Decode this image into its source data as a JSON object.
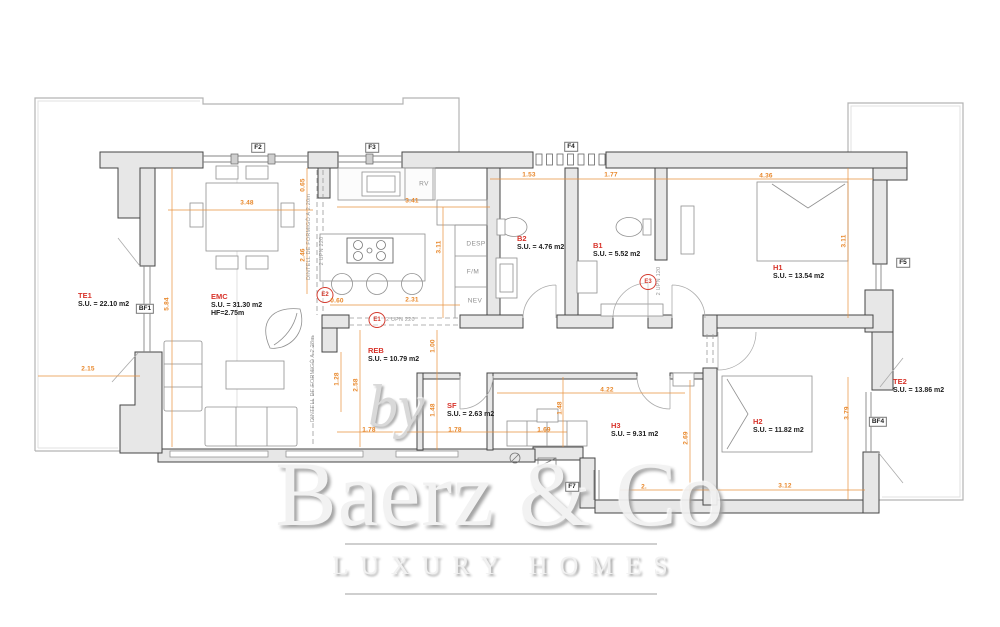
{
  "watermark": {
    "prefix": "by",
    "brand": "Baerz & Co",
    "tagline": "LUXURY HOMES"
  },
  "rooms": {
    "te1": {
      "name": "TE1",
      "area": "S.U. = 22.10 m2"
    },
    "emc": {
      "name": "EMC",
      "area": "S.U. = 31.30 m2",
      "height": "HF=2.75m"
    },
    "reb": {
      "name": "REB",
      "area": "S.U. = 10.79 m2"
    },
    "sf": {
      "name": "SF",
      "area": "S.U. = 2.63 m2"
    },
    "b2": {
      "name": "B2",
      "area": "S.U. = 4.76 m2"
    },
    "b1": {
      "name": "B1",
      "area": "S.U. = 5.52 m2"
    },
    "h1": {
      "name": "H1",
      "area": "S.U. = 13.54 m2"
    },
    "h3": {
      "name": "H3",
      "area": "S.U. = 9.31 m2"
    },
    "h2": {
      "name": "H2",
      "area": "S.U. = 11.82 m2"
    },
    "te2": {
      "name": "TE2",
      "area": "S.U. = 13.86 m2"
    }
  },
  "tags": {
    "f2": "F2",
    "f3": "F3",
    "f4": "F4",
    "f5": "F5",
    "f7": "F7",
    "bf1": "BF1",
    "bf4": "BF4"
  },
  "markers": {
    "e1": "E1",
    "e2": "E2",
    "e3": "E3"
  },
  "beams": {
    "e1_note": "2 UPN 220",
    "e2_note": "2 UPN 220",
    "e3_note": "2 UPN 120",
    "lintel_220": "DINTELL DE FORMIGÓ A 2.20m",
    "lintel_228": "DINTELL DE FORMIGÓ A 2.28m"
  },
  "kitchen": {
    "rv": "RV",
    "desp": "DESP",
    "fm": "F/M",
    "nev": "NEV"
  },
  "dimensions": {
    "dining_w": "3.48",
    "win_top": "0.65",
    "dining_h": "2.46",
    "kitchen_w": "3.41",
    "kitchen_h": "3.11",
    "b2_w": "1.53",
    "b1_w": "1.77",
    "h1_w": "4.36",
    "h1_h": "3.11",
    "pass": "0.60",
    "island_w": "2.31",
    "living_h": "5.84",
    "te1_w": "2.15",
    "sofa_h": "1.28",
    "living_r": "2.58",
    "hall_h": "1.00",
    "sf_h": "1.48",
    "reb_a": "1.78",
    "reb_b": "1.78",
    "closet_w": "1.69",
    "h3_w": "4.22",
    "closet_h": "1.48",
    "h2_l": "2.69",
    "h2_w": "3.12",
    "te2_h": "3.79",
    "entry_w": "2."
  },
  "colors": {
    "dimension": "#e8872a",
    "room_label": "#d8332a",
    "wall_fill": "#e7e7e7"
  }
}
